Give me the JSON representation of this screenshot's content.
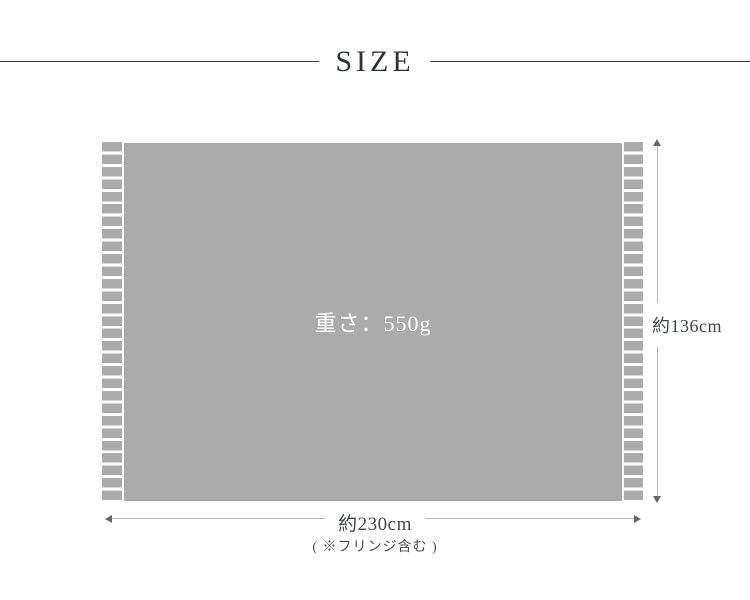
{
  "title": "SIZE",
  "product": {
    "weight": "重さ：550g"
  },
  "dimensions": {
    "height": "約136cm",
    "width": "約230cm",
    "note": "( ※フリンジ含む )"
  },
  "colors": {
    "body_gray": "#ababab",
    "fringe_gray": "#ababab",
    "dimension_line": "#bcbcbc",
    "arrowhead": "#63666c",
    "title_text": "#2f333c",
    "title_rule": "#3e4148",
    "label_text": "#45484e",
    "weight_text": "#ffffff",
    "background": "#ffffff"
  }
}
